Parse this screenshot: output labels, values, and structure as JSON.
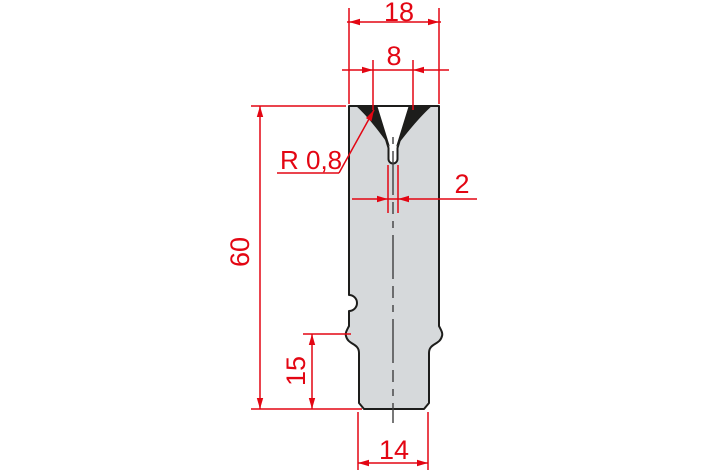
{
  "drawing": {
    "type": "technical-drawing",
    "subject": "V-die cross-section (press brake bottom die)",
    "dimensions": {
      "die_width": "18",
      "v_opening": "8",
      "groove_radius": "R 0,8",
      "slot_width": "2",
      "die_height": "60",
      "shank_height": "15",
      "shank_width": "14"
    },
    "colors": {
      "dimension_red": "#e30613",
      "body_fill": "#d6d9db",
      "outline": "#1d1d1b",
      "centerline": "#3f3f3f",
      "background": "#ffffff"
    }
  }
}
